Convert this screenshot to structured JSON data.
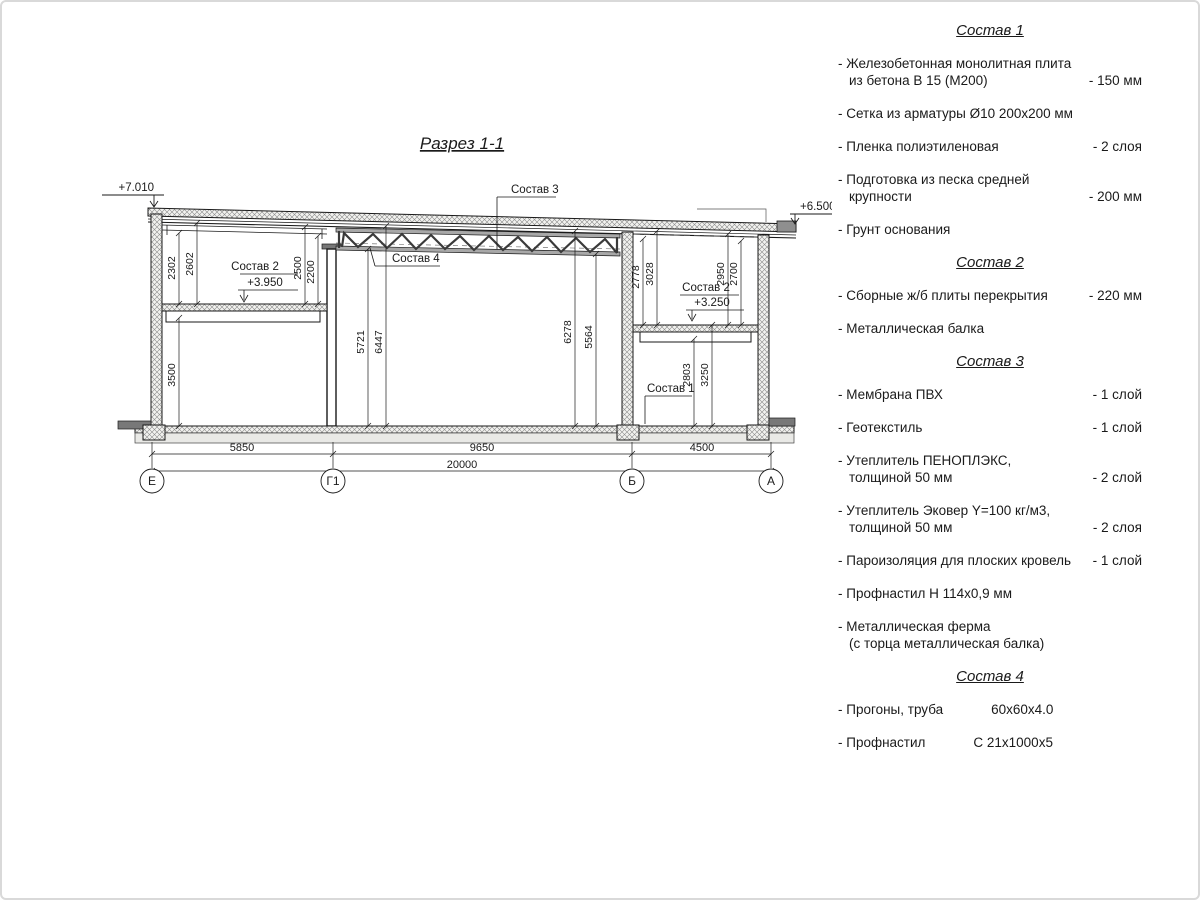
{
  "drawing": {
    "title": "Разрез 1-1",
    "axes": [
      "Е",
      "Г1",
      "Б",
      "А"
    ],
    "marks": {
      "m7010": "+7.010",
      "m6500": "+6.500",
      "m3950": "+3.950",
      "m3250": "+3.250"
    },
    "callouts": {
      "c1": "Состав 1",
      "c2": "Состав 2",
      "c3": "Состав 3",
      "c4": "Состав 4"
    },
    "dims": {
      "h2302": "2302",
      "h2602": "2602",
      "h2500": "2500",
      "h2200": "2200",
      "h5721": "5721",
      "h6447": "6447",
      "h6278": "6278",
      "h5564": "5564",
      "h2778": "2778",
      "h3028": "3028",
      "h2950": "2950",
      "h2700": "2700",
      "h2803": "2803",
      "h3250": "3250",
      "h3500": "3500",
      "w5850": "5850",
      "w9650": "9650",
      "w4500": "4500",
      "w20000": "20000"
    },
    "colors": {
      "line": "#1a1a1a",
      "hatch": "#8a8a8a"
    }
  },
  "specs": {
    "sections": [
      {
        "title": "Состав 1",
        "items": [
          {
            "name": "- Железобетонная  монолитная плита",
            "name2": "из бетона В 15 (М200)",
            "value": "- 150 мм"
          },
          {
            "name": "- Сетка из арматуры Ø10 200х200 мм",
            "value": ""
          },
          {
            "name": "- Пленка полиэтиленовая",
            "value": "-  2 слоя"
          },
          {
            "name": "- Подготовка из песка средней",
            "name2": "крупности",
            "value": "- 200 мм"
          },
          {
            "name": "- Грунт основания",
            "value": ""
          }
        ]
      },
      {
        "title": "Состав 2",
        "items": [
          {
            "name": "- Сборные ж/б плиты перекрытия",
            "value": "- 220 мм"
          },
          {
            "name": "- Металлическая балка",
            "value": ""
          }
        ]
      },
      {
        "title": "Состав 3",
        "items": [
          {
            "name": "- Мембрана ПВХ",
            "value": "- 1 слой"
          },
          {
            "name": "- Геотекстиль",
            "value": "- 1 слой"
          },
          {
            "name": "- Утеплитель ПЕНОПЛЭКС,",
            "name2": "толщиной 50 мм",
            "value": "- 2 слой"
          },
          {
            "name": "- Утеплитель Эковер Y=100 кг/м3,",
            "name2": "толщиной 50 мм",
            "value": "- 2 слоя"
          },
          {
            "name": "- Пароизоляция для плоских кровель",
            "value": "- 1 слой"
          },
          {
            "name": "- Профнастил Н 114х0,9 мм",
            "value": ""
          },
          {
            "name": "- Металлическая ферма",
            "name2": "(с торца металлическая балка)",
            "value": ""
          }
        ]
      },
      {
        "title": "Состав 4",
        "items": [
          {
            "name": "- Прогоны, труба",
            "mid": "60х60х4.0"
          },
          {
            "name": "- Профнастил",
            "mid": "С 21х1000х5"
          }
        ]
      }
    ]
  }
}
